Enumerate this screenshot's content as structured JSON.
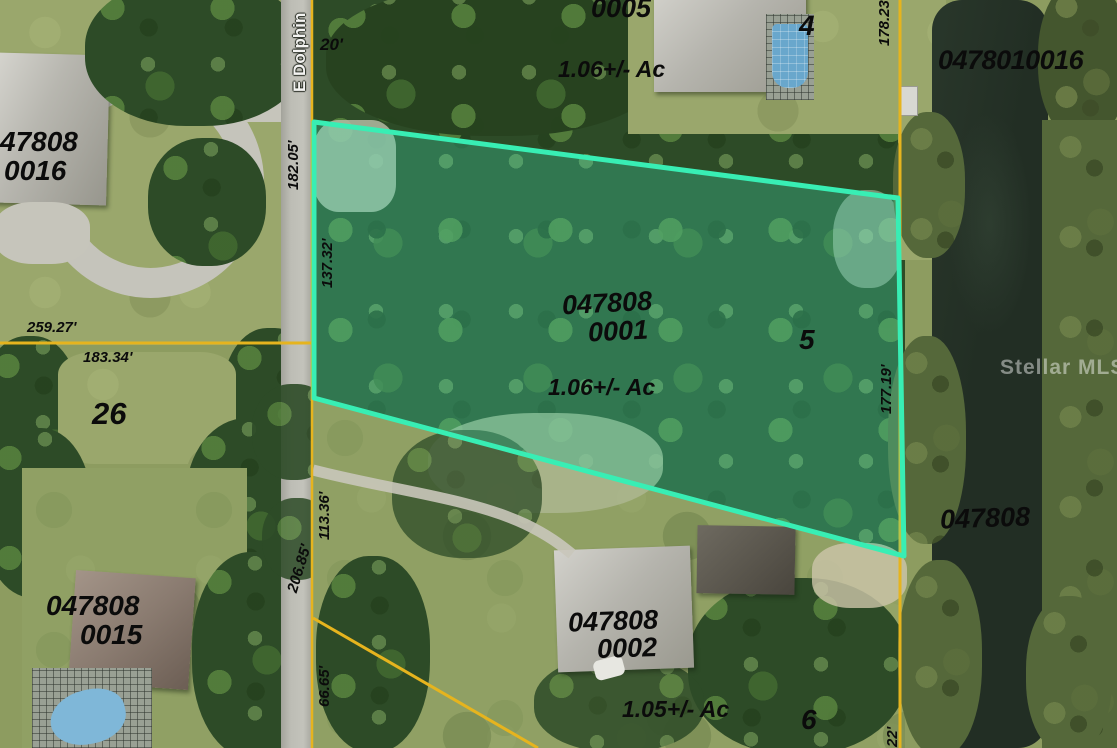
{
  "map_type": "aerial-parcel-map",
  "watermark": "Stellar MLS",
  "street": {
    "name": "E Dolphin"
  },
  "highlight": {
    "border": "#38eeb4",
    "fill": "rgba(62,232,186,0.28)",
    "subject_parcel": "047808 0001"
  },
  "boundary_color": "#e6b41e",
  "parcels": {
    "nw": {
      "line1": "47808",
      "line2": "0016"
    },
    "north": {
      "id": "0005",
      "lot": "4",
      "area": "1.06+/- Ac"
    },
    "canal": {
      "id": "0478010016"
    },
    "subject": {
      "line1": "047808",
      "line2": "0001",
      "lot": "5",
      "area": "1.06+/- Ac"
    },
    "west": {
      "lot": "26"
    },
    "sw": {
      "line1": "047808",
      "line2": "0015"
    },
    "south": {
      "line1": "047808",
      "line2": "0002",
      "lot": "6",
      "area": "1.05+/- Ac"
    },
    "se_water": {
      "id": "047808"
    }
  },
  "dimensions": {
    "road_width": "20'",
    "west_north": "182.05'",
    "subject_west": "137.32'",
    "south_road_upper": "113.36'",
    "road_west": "206.85'",
    "south_road_lower": "66.65'",
    "left_upper": "259.27'",
    "left_lower": "183.34'",
    "north_east": "178.23'",
    "subject_east": "177.19'",
    "se_corner": "22'"
  }
}
